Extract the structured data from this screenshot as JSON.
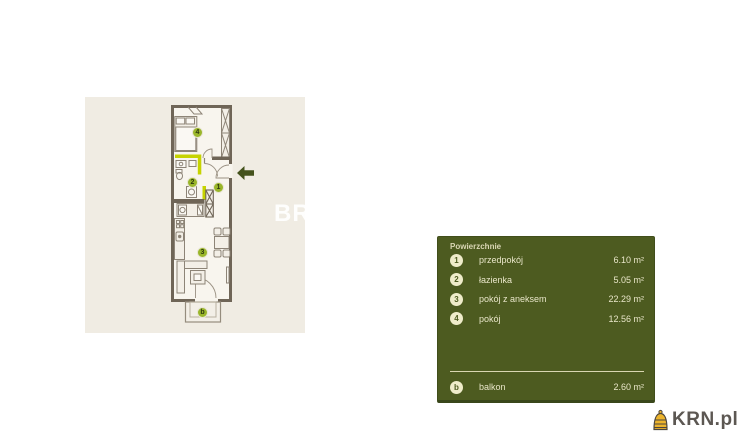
{
  "floorplan": {
    "watermark": "BR",
    "markers": [
      {
        "label": "4"
      },
      {
        "label": "2"
      },
      {
        "label": "1"
      },
      {
        "label": "3"
      },
      {
        "label": "b"
      }
    ],
    "colors": {
      "card_bg": "#f0ece3",
      "interior": "#f8f5ee",
      "wall": "#6f6557",
      "accent": "#c6d300",
      "marker_fill": "#9ab62a",
      "entry_arrow": "#44521c"
    }
  },
  "legend": {
    "title": "Powierzchnie",
    "rows": [
      {
        "num": "1",
        "label": "przedpokój",
        "value": "6.10 m²"
      },
      {
        "num": "2",
        "label": "łazienka",
        "value": "5.05 m²"
      },
      {
        "num": "3",
        "label": "pokój z aneksem",
        "value": "22.29 m²"
      },
      {
        "num": "4",
        "label": "pokój",
        "value": "12.56 m²"
      }
    ],
    "balcony_row": {
      "num": "b",
      "label": "balkon",
      "value": "2.60 m²"
    },
    "colors": {
      "panel_bg": "#4d5b20",
      "badge_bg": "#efecca",
      "text": "#e9e6c9",
      "divider": "#d9d6b2"
    }
  },
  "logo": {
    "text": "KRN.pl",
    "icon": "beehive-icon",
    "colors": {
      "icon": "#ecb42d",
      "text": "#5c5752"
    }
  }
}
